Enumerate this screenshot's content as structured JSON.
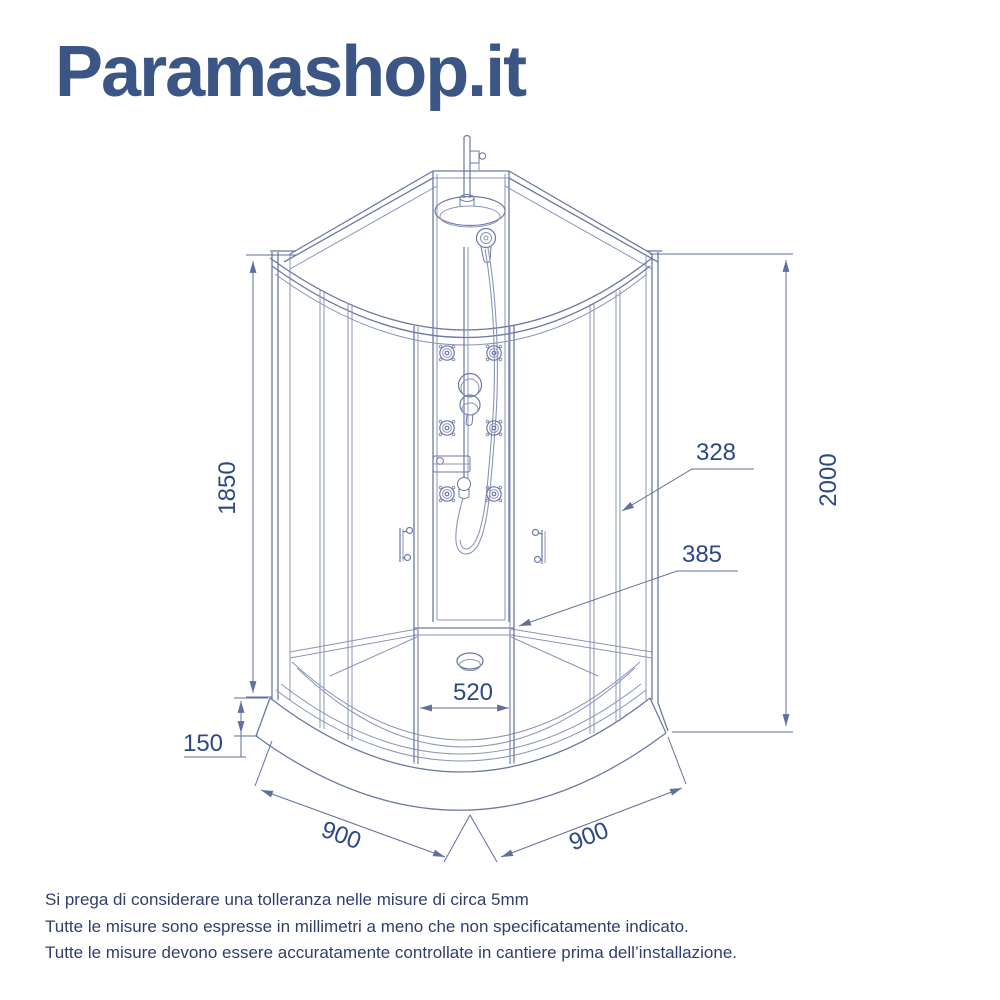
{
  "logo": {
    "text": "Paramashop.it",
    "color": "#3b5585"
  },
  "diagram": {
    "type": "technical-drawing",
    "subject": "cabina doccia semicircolare con colonna idromassaggio",
    "dimensions": {
      "inner_height": "1850",
      "total_height": "2000",
      "upper_leader": "328",
      "lower_leader": "385",
      "door_opening_width": "520",
      "tray_height": "150",
      "left_side_width": "900",
      "right_side_width": "900"
    }
  },
  "footer": {
    "lines": [
      "Si prega di considerare una tolleranza nelle misure di circa 5mm",
      "Tutte le misure sono espresse in millimetri a meno che non specificatamente indicato.",
      "Tutte le misure devono essere accuratamente controllate in cantiere prima dell’installazione."
    ]
  },
  "colors": {
    "line_light": "#8a94b8",
    "line_medium": "#6b79a4",
    "dimension_line": "#5f6f9e",
    "dimension_text": "#2c4886",
    "body_text": "#2f3e6d",
    "logo_text": "#3b5585"
  }
}
